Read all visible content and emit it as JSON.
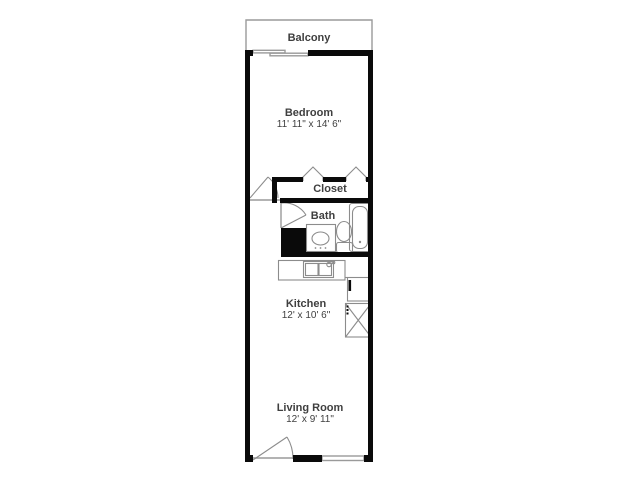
{
  "floorplan": {
    "title": "apartment-floor-plan",
    "colors": {
      "wall": "#0a0a0a",
      "thin_line": "#9a9a9a",
      "fixture_line": "#8c8c8c",
      "text": "#3f3f3f",
      "background": "#ffffff"
    },
    "rooms": {
      "balcony": {
        "name": "Balcony",
        "dims": ""
      },
      "bedroom": {
        "name": "Bedroom",
        "dims": "11' 11\" x 14' 6\""
      },
      "closet": {
        "name": "Closet",
        "dims": ""
      },
      "bath": {
        "name": "Bath",
        "dims": ""
      },
      "kitchen": {
        "name": "Kitchen",
        "dims": "12' x 10' 6\""
      },
      "living_room": {
        "name": "Living Room",
        "dims": "12' x 9' 11\""
      }
    },
    "fixtures": [
      "bathtub",
      "toilet",
      "vanity-sink",
      "plumbing-chase",
      "kitchen-counter",
      "kitchen-sink",
      "refrigerator",
      "washer-dryer"
    ],
    "openings": [
      "balcony-sliding-door",
      "bedroom-door",
      "closet-bifold-doors",
      "bath-door",
      "entry-door",
      "living-room-window"
    ]
  }
}
